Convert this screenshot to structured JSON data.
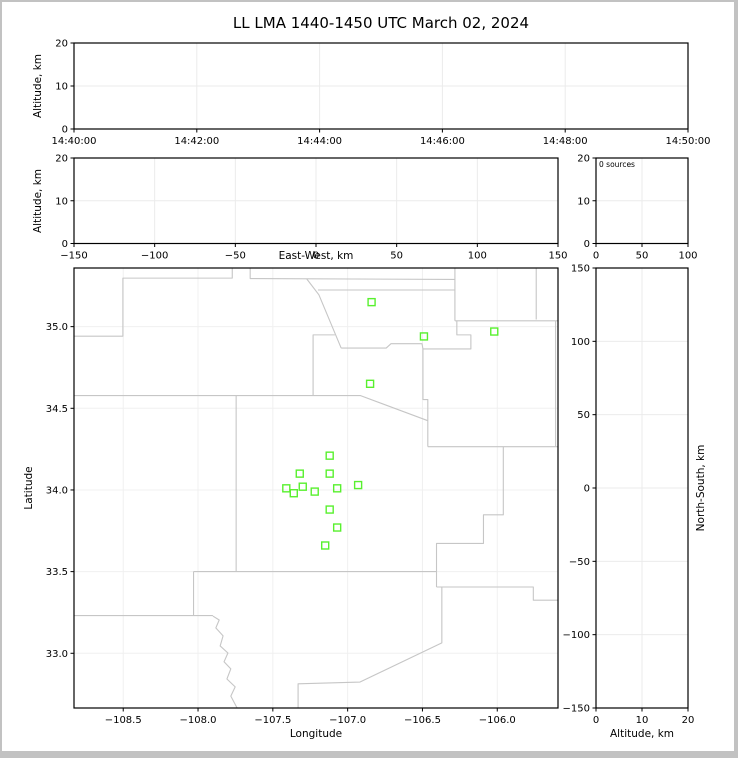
{
  "figure": {
    "title": "LL LMA 1440-1450 UTC March 02, 2024",
    "background_color": "#ffffff",
    "frame_color": "#000000",
    "grid_color": "#ebebeb",
    "map_grid_color": "#f0f0f0",
    "county_line_color": "#c6c6c6",
    "station_marker_color": "#58f02e",
    "border_color": "#c2c2c2"
  },
  "chart_data": {
    "type": "scatter",
    "title": "LL LMA 1440-1450 UTC March 02, 2024",
    "legend_position": "none",
    "grid": "on",
    "panels": {
      "time_height": {
        "ylabel": "Altitude, km",
        "xticks": [
          "14:40:00",
          "14:42:00",
          "14:44:00",
          "14:46:00",
          "14:48:00",
          "14:50:00"
        ],
        "yticks": [
          "0",
          "10",
          "20"
        ],
        "ylim": [
          0,
          20
        ],
        "points": []
      },
      "ew_height": {
        "xlabel": "East-West, km",
        "ylabel": "Altitude, km",
        "xticks": [
          "−150",
          "−100",
          "−50",
          "0",
          "50",
          "100",
          "150"
        ],
        "xlim": [
          -150,
          150
        ],
        "yticks": [
          "0",
          "10",
          "20"
        ],
        "ylim": [
          0,
          20
        ],
        "points": []
      },
      "src_hist": {
        "annotation": "0 sources",
        "xticks": [
          "0",
          "50",
          "100"
        ],
        "xlim": [
          0,
          100
        ],
        "yticks": [
          "0",
          "10",
          "20"
        ],
        "ylim": [
          0,
          20
        ],
        "points": []
      },
      "plan_view": {
        "xlabel": "Longitude",
        "ylabel": "Latitude",
        "xticks": [
          "−108.5",
          "−108.0",
          "−107.5",
          "−107.0",
          "−106.5",
          "−106.0"
        ],
        "xlim": [
          -108.829,
          -105.594
        ],
        "yticks": [
          "33.0",
          "33.5",
          "34.0",
          "34.5",
          "35.0"
        ],
        "ylim": [
          32.665,
          35.359
        ],
        "stations_lon_lat": [
          [
            -106.84,
            35.15
          ],
          [
            -106.49,
            34.94
          ],
          [
            -106.02,
            34.97
          ],
          [
            -106.85,
            34.65
          ],
          [
            -107.12,
            34.21
          ],
          [
            -107.32,
            34.1
          ],
          [
            -107.12,
            34.1
          ],
          [
            -107.41,
            34.01
          ],
          [
            -107.3,
            34.02
          ],
          [
            -107.36,
            33.98
          ],
          [
            -107.22,
            33.99
          ],
          [
            -107.07,
            34.01
          ],
          [
            -106.93,
            34.03
          ],
          [
            -107.12,
            33.88
          ],
          [
            -107.07,
            33.77
          ],
          [
            -107.15,
            33.66
          ]
        ],
        "county_lines_pct": [
          [
            [
              0,
              15.5
            ],
            [
              10.1,
              15.5
            ],
            [
              10.1,
              2.3
            ],
            [
              32.7,
              2.3
            ],
            [
              32.7,
              0
            ]
          ],
          [
            [
              36.4,
              0
            ],
            [
              36.4,
              2.4
            ],
            [
              78.7,
              2.6
            ]
          ],
          [
            [
              48.1,
              2.5
            ],
            [
              50.6,
              6.1
            ],
            [
              55.2,
              18.2
            ]
          ],
          [
            [
              50.4,
              5.0
            ],
            [
              78.7,
              5.0
            ]
          ],
          [
            [
              55.2,
              18.2
            ],
            [
              64.5,
              18.2
            ],
            [
              65.5,
              17.2
            ],
            [
              71.9,
              17.2
            ],
            [
              72.1,
              18.4
            ],
            [
              82.0,
              18.4
            ],
            [
              82.0,
              15.2
            ],
            [
              79.1,
              15.2
            ],
            [
              79.1,
              12.0
            ]
          ],
          [
            [
              78.7,
              0
            ],
            [
              78.7,
              12.0
            ]
          ],
          [
            [
              78.7,
              12.0
            ],
            [
              100,
              12.0
            ]
          ],
          [
            [
              95.5,
              0
            ],
            [
              95.5,
              11.7
            ]
          ],
          [
            [
              99.5,
              12.0
            ],
            [
              99.5,
              40.6
            ]
          ],
          [
            [
              53.9,
              15.2
            ],
            [
              49.4,
              15.2
            ],
            [
              49.4,
              29.1
            ]
          ],
          [
            [
              0,
              29.0
            ],
            [
              59.2,
              29.0
            ],
            [
              73.1,
              34.7
            ]
          ],
          [
            [
              72.1,
              18.4
            ],
            [
              72.1,
              29.9
            ],
            [
              73.1,
              29.9
            ],
            [
              73.1,
              40.6
            ]
          ],
          [
            [
              73.1,
              40.6
            ],
            [
              100,
              40.6
            ]
          ],
          [
            [
              88.7,
              40.6
            ],
            [
              88.7,
              56.1
            ],
            [
              84.6,
              56.1
            ],
            [
              84.6,
              62.6
            ],
            [
              74.9,
              62.6
            ],
            [
              74.9,
              72.5
            ]
          ],
          [
            [
              74.9,
              72.5
            ],
            [
              94.9,
              72.5
            ],
            [
              94.9,
              75.5
            ],
            [
              100,
              75.5
            ]
          ],
          [
            [
              76.0,
              72.5
            ],
            [
              76.0,
              85.2
            ],
            [
              59.1,
              94.1
            ],
            [
              46.3,
              94.5
            ],
            [
              46.3,
              100
            ]
          ],
          [
            [
              33.5,
              29.0
            ],
            [
              33.5,
              69.0
            ]
          ],
          [
            [
              24.7,
              69.0
            ],
            [
              74.9,
              69.0
            ]
          ],
          [
            [
              24.7,
              69.0
            ],
            [
              24.7,
              79.0
            ]
          ],
          [
            [
              0,
              79.0
            ],
            [
              28.7,
              79.0
            ]
          ],
          [
            [
              28.7,
              79.1
            ],
            [
              30.0,
              80.0
            ],
            [
              29.3,
              81.8
            ],
            [
              30.8,
              83.6
            ],
            [
              30.2,
              85.9
            ],
            [
              31.8,
              87.5
            ],
            [
              31.0,
              89.5
            ],
            [
              32.4,
              91.1
            ],
            [
              31.6,
              93.4
            ],
            [
              33.3,
              95.2
            ],
            [
              32.4,
              97.3
            ],
            [
              33.7,
              100
            ]
          ]
        ]
      },
      "ns_height": {
        "xlabel": "Altitude, km",
        "ylabel": "North-South, km",
        "xticks": [
          "0",
          "10",
          "20"
        ],
        "xlim": [
          0,
          20
        ],
        "yticks": [
          "−150",
          "−100",
          "−50",
          "0",
          "50",
          "100",
          "150"
        ],
        "ylim": [
          -150,
          150
        ],
        "points": []
      }
    }
  }
}
